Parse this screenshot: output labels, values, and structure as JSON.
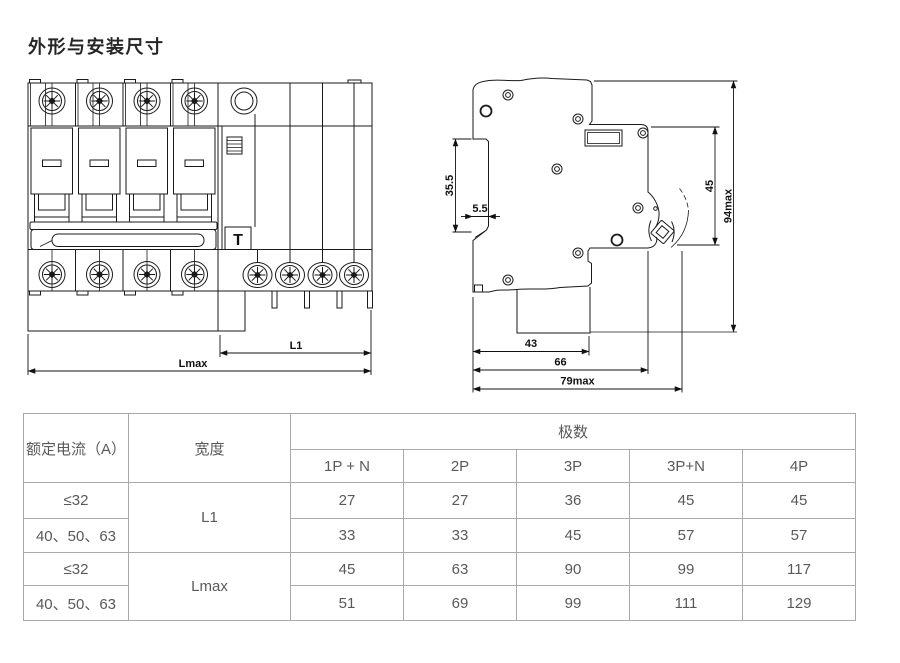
{
  "title": "外形与安装尺寸",
  "drawings": {
    "front": {
      "dim_l1": "L1",
      "dim_lmax": "Lmax",
      "test_button": "T"
    },
    "side": {
      "dim_din_slot": "35.5",
      "dim_claw": "5.5",
      "dim_front_face": "45",
      "dim_total_height": "94max",
      "dim_depth_43": "43",
      "dim_depth_66": "66",
      "dim_depth_79": "79max"
    }
  },
  "table": {
    "headers": {
      "current": "额定电流（A）",
      "width": "宽度",
      "poles": "极数"
    },
    "pole_columns": [
      "1P + N",
      "2P",
      "3P",
      "3P+N",
      "4P"
    ],
    "groups": [
      {
        "width_label": "L1",
        "rows": [
          {
            "current": "≤32",
            "values": [
              "27",
              "27",
              "36",
              "45",
              "45"
            ]
          },
          {
            "current": "40、50、63",
            "values": [
              "33",
              "33",
              "45",
              "57",
              "57"
            ]
          }
        ]
      },
      {
        "width_label": "Lmax",
        "rows": [
          {
            "current": "≤32",
            "values": [
              "45",
              "63",
              "90",
              "99",
              "117"
            ]
          },
          {
            "current": "40、50、63",
            "values": [
              "51",
              "69",
              "99",
              "111",
              "129"
            ]
          }
        ]
      }
    ]
  },
  "colors": {
    "line": "#1a1a1a",
    "table_border": "#a9a9a9",
    "table_text": "#595959",
    "title_text": "#262626"
  }
}
